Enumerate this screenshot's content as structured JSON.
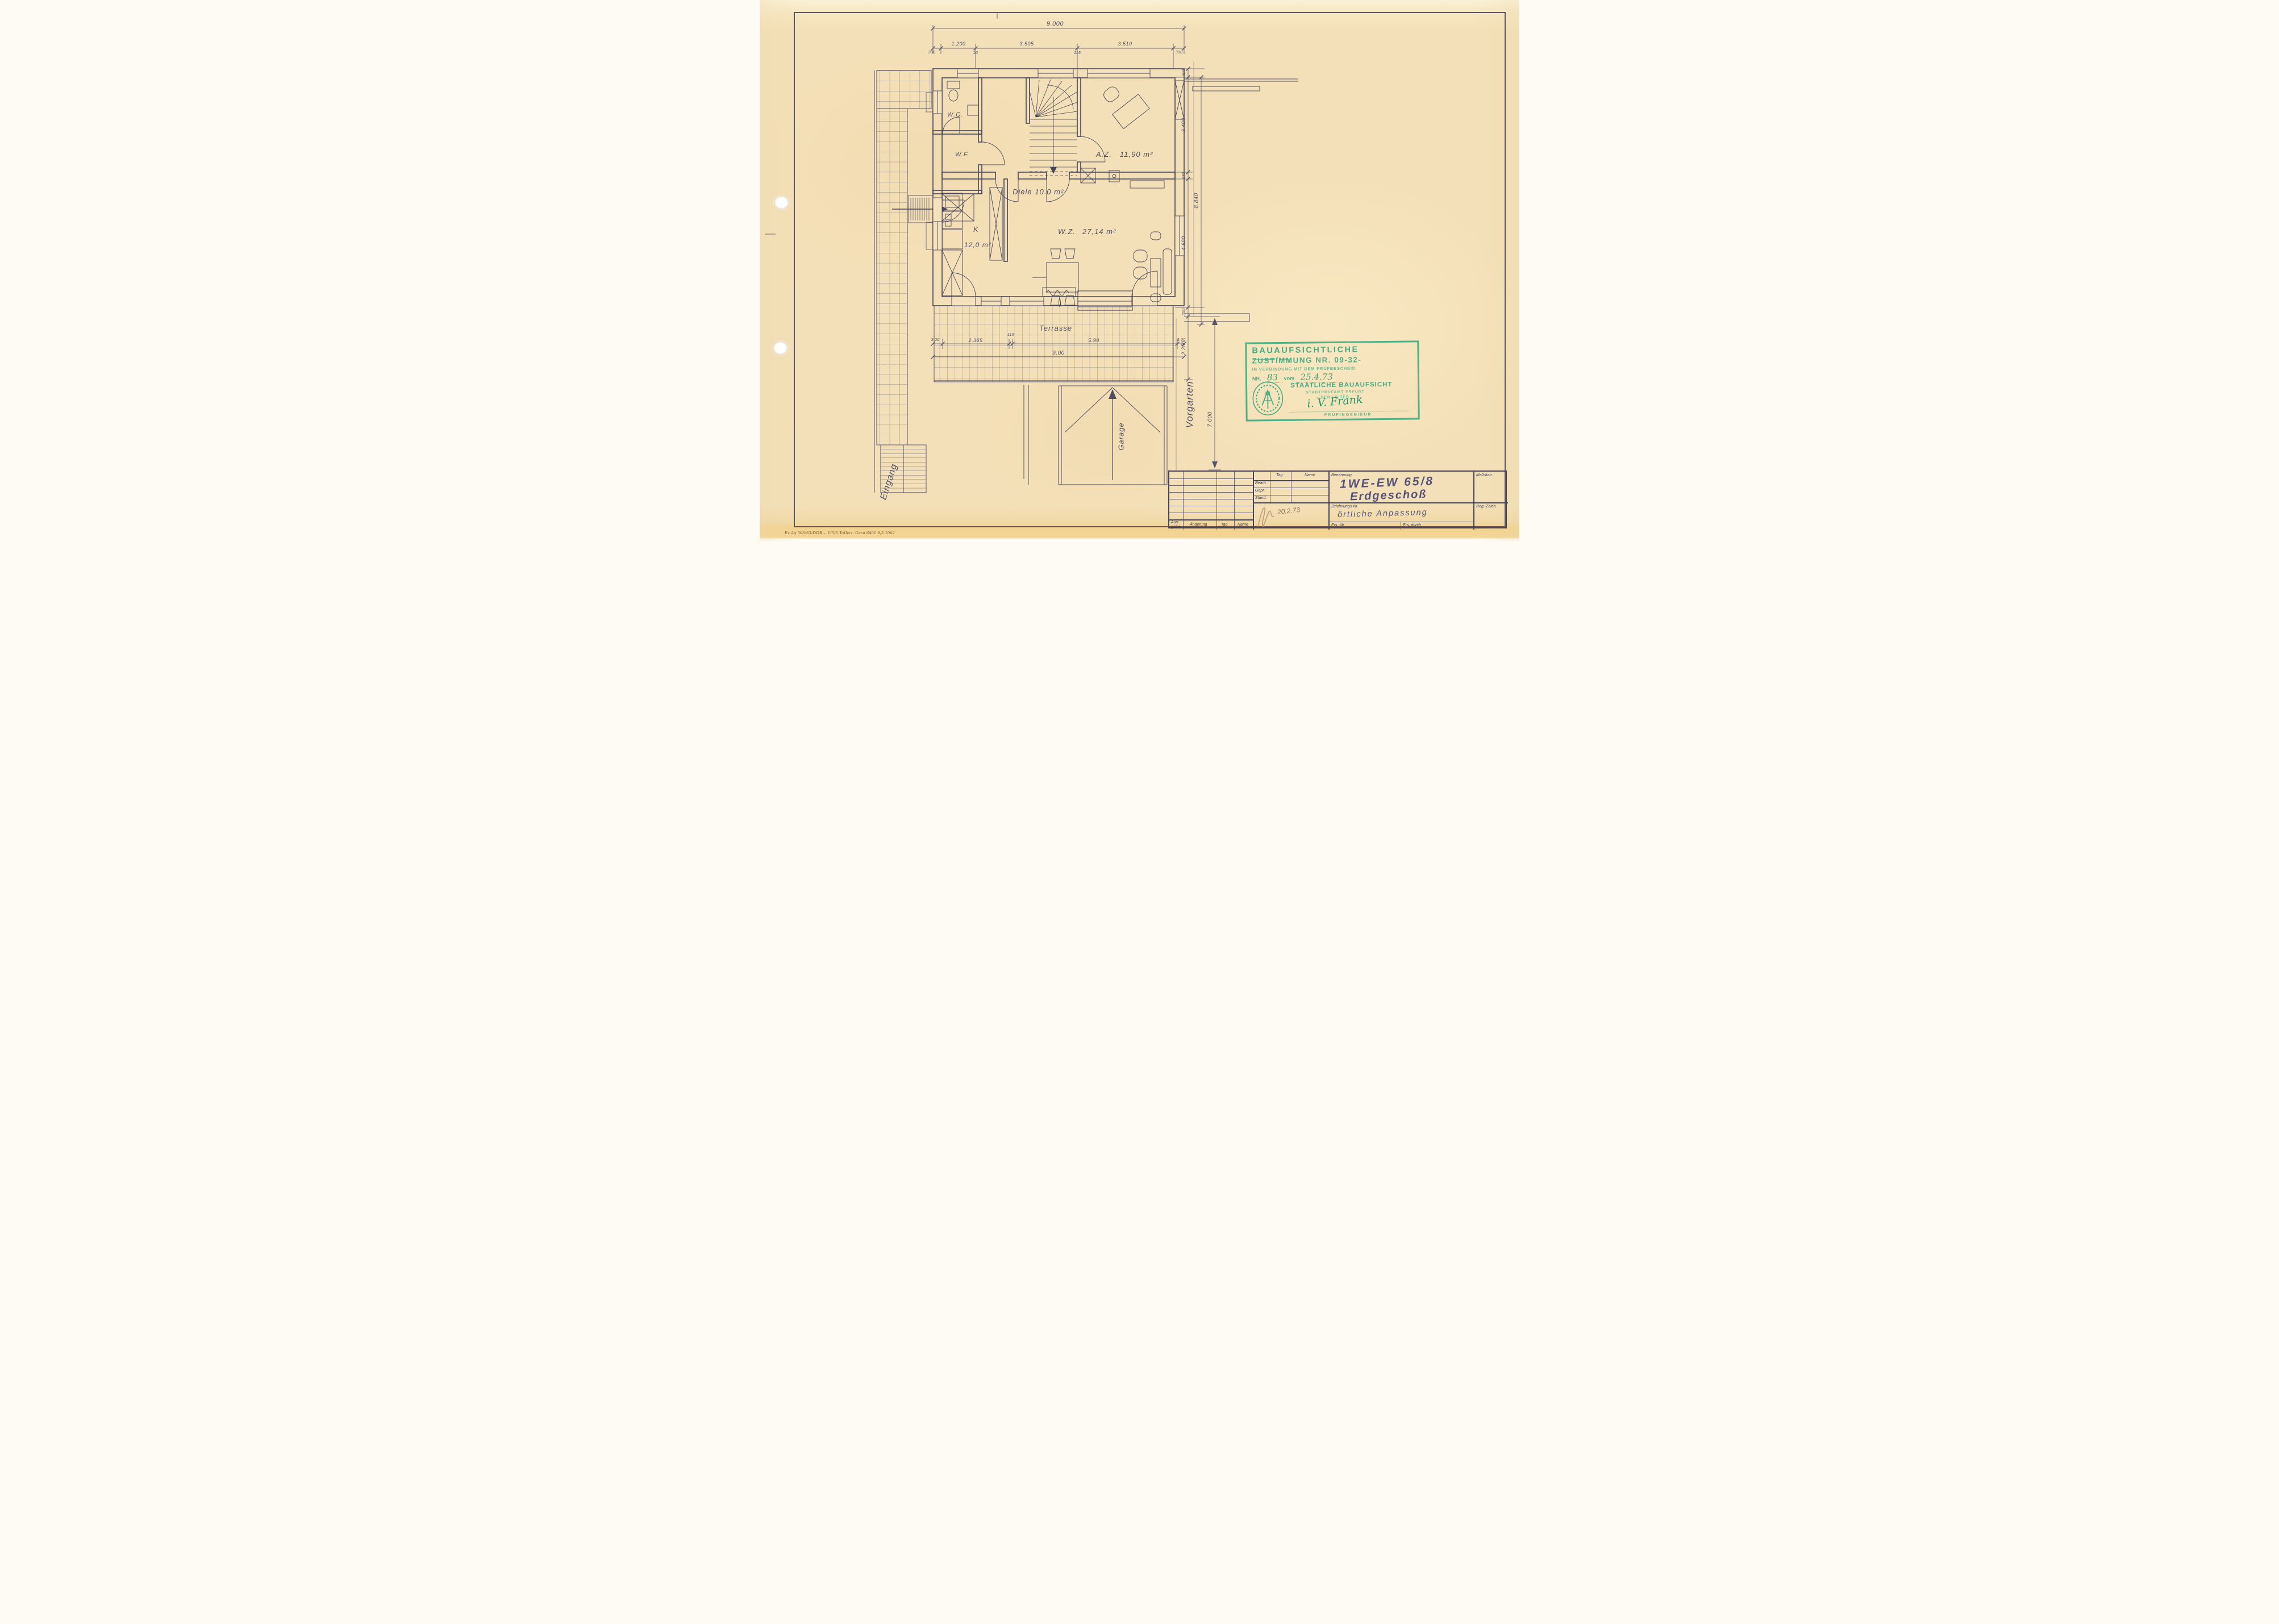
{
  "sheet": {
    "footer_code": "Ev Ag 305/63/DDR – V/5/6 Tollert, Gera   6401  8,3   1062"
  },
  "plan": {
    "rooms": {
      "wc": "W.C.",
      "wf": "W.F.",
      "diele": "Diele 10.0 m²",
      "az": "A.Z.",
      "az_area": "11,90 m²",
      "kitchen": "K",
      "kitchen_area": "12,0 m²",
      "wz": "W.Z.",
      "wz_area": "27,14 m²",
      "terrasse": "Terrasse",
      "garage": "Garage",
      "vorgarten": "Vorgarten",
      "eingang": "Eingang"
    },
    "dims": {
      "top_total": "9.000",
      "top_seg_left": "300",
      "top_seg_1200": "1.200",
      "top_seg_10": "10",
      "top_seg_3505": "3.505",
      "top_seg_115": "115",
      "top_seg_3510": "3.510",
      "top_seg_right": "300",
      "right_300_top": "300",
      "right_3400": "3.400",
      "right_240": "240",
      "right_4600": "4.600",
      "right_total": "8.840",
      "right_300_bottom": "300",
      "front_2250": "2.250",
      "front_7000": "7.000",
      "ter_left": "3.00",
      "ter_2385": "2.385",
      "ter_115": "115",
      "ter_590": "5.90",
      "ter_right": "3.00",
      "ter_total": "9.00"
    }
  },
  "stamp": {
    "line1": "BAUAUFSICHTLICHE",
    "line2": "ZUSTIMMUNG NR. 09-32-",
    "line2_suffix": "―――― / ――",
    "line3": "IN VERBINDUNG MIT DEM PRÜFBESCHEID",
    "nr_label": "NR.",
    "nr_value": "83",
    "vom_label": "vom",
    "date_value": "25.4.73",
    "org": "STAATLICHE BAUAUFSICHT",
    "office": "STADTPRÜFAMT ERFURT",
    "leader": "- DER LEITER -",
    "signature": "i. V. Frank",
    "role": "PRÜFINGENIEUR"
  },
  "titleblock": {
    "rev": {
      "ausgabe": "Aus- gabe",
      "aenderung": "Änderung",
      "tag": "Tag",
      "name": "Name"
    },
    "mid": {
      "tag": "Tag",
      "name": "Name",
      "bearb": "Bearb.",
      "gepr": "Gepr.",
      "stand": "Stand.",
      "date": "20.2.73"
    },
    "benennung_label": "Benennung",
    "benennung_line1": "1WE-EW 65/8",
    "benennung_line2": "Erdgeschoß",
    "massstab_label": "Maßstab",
    "zeichnung_label": "Zeichnungs-Nr.",
    "zeichnung_value": "örtliche Anpassung",
    "reg_label": "Reg.-Zeich.",
    "ers_fuer": "Ers. für",
    "ers_durch": "Ers. durch"
  }
}
